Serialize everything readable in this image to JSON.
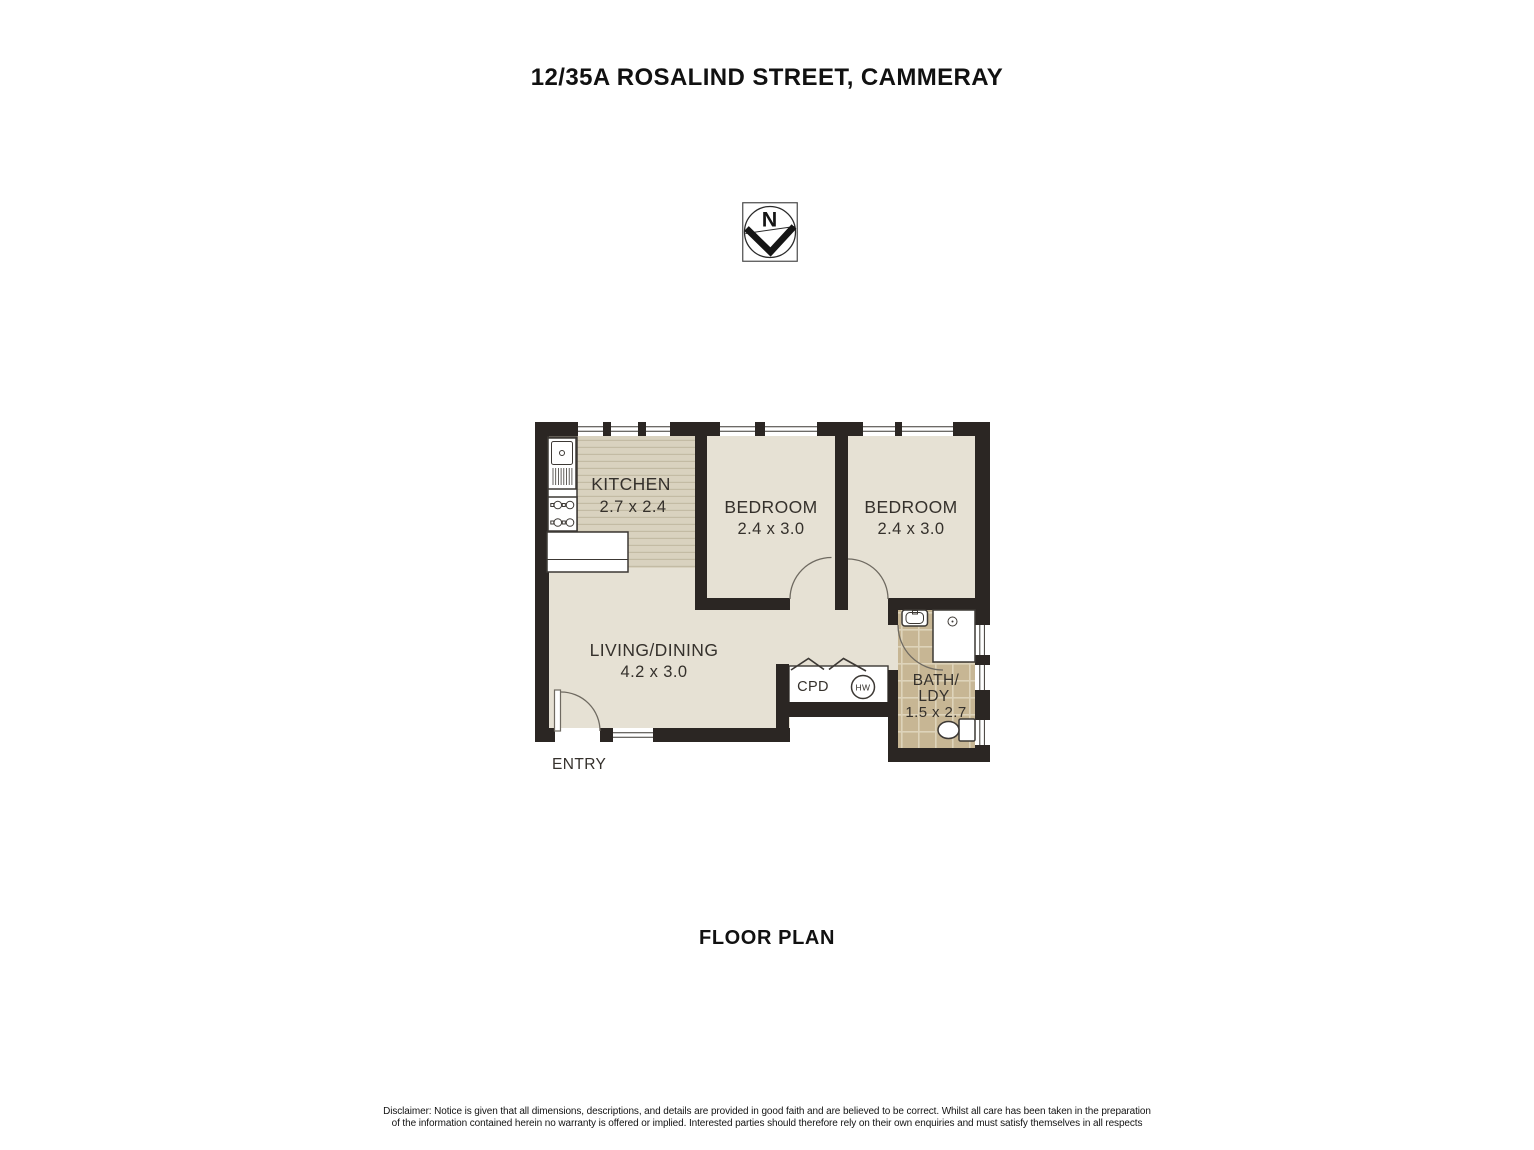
{
  "title": "12/35A ROSALIND STREET, CAMMERAY",
  "caption": "FLOOR PLAN",
  "compass": {
    "north_label": "N"
  },
  "plan": {
    "rooms": [
      {
        "id": "kitchen",
        "label": "KITCHEN",
        "dims": "2.7 x 2.4"
      },
      {
        "id": "bedroom-1",
        "label": "BEDROOM",
        "dims": "2.4 x 3.0"
      },
      {
        "id": "bedroom-2",
        "label": "BEDROOM",
        "dims": "2.4 x 3.0"
      },
      {
        "id": "living-dining",
        "label": "LIVING/DINING",
        "dims": "4.2 x 3.0"
      },
      {
        "id": "bath-laundry",
        "label": "BATH/",
        "label2": "LDY",
        "dims": "1.5 x 2.7"
      }
    ],
    "features": {
      "cupboard": "CPD",
      "hot_water": "HW",
      "entry": "ENTRY"
    }
  },
  "disclaimer": {
    "line1": "Disclaimer: Notice is given that all dimensions, descriptions, and details are provided in good faith and are believed to be correct. Whilst all care has been taken in the preparation",
    "line2": "of the information contained herein no warranty is offered or implied. Interested parties should therefore rely on their own enquiries and must satisfy themselves in all respects"
  },
  "colors": {
    "wall": "#2b2623",
    "floor": "#e6e1d4",
    "kitchen-floor": "#d9d2bf",
    "kitchen-stripe": "#c3bba4",
    "tile": "#c7b694",
    "grout": "#ded3ba",
    "line": "#3c3834",
    "text": "#35312c"
  }
}
